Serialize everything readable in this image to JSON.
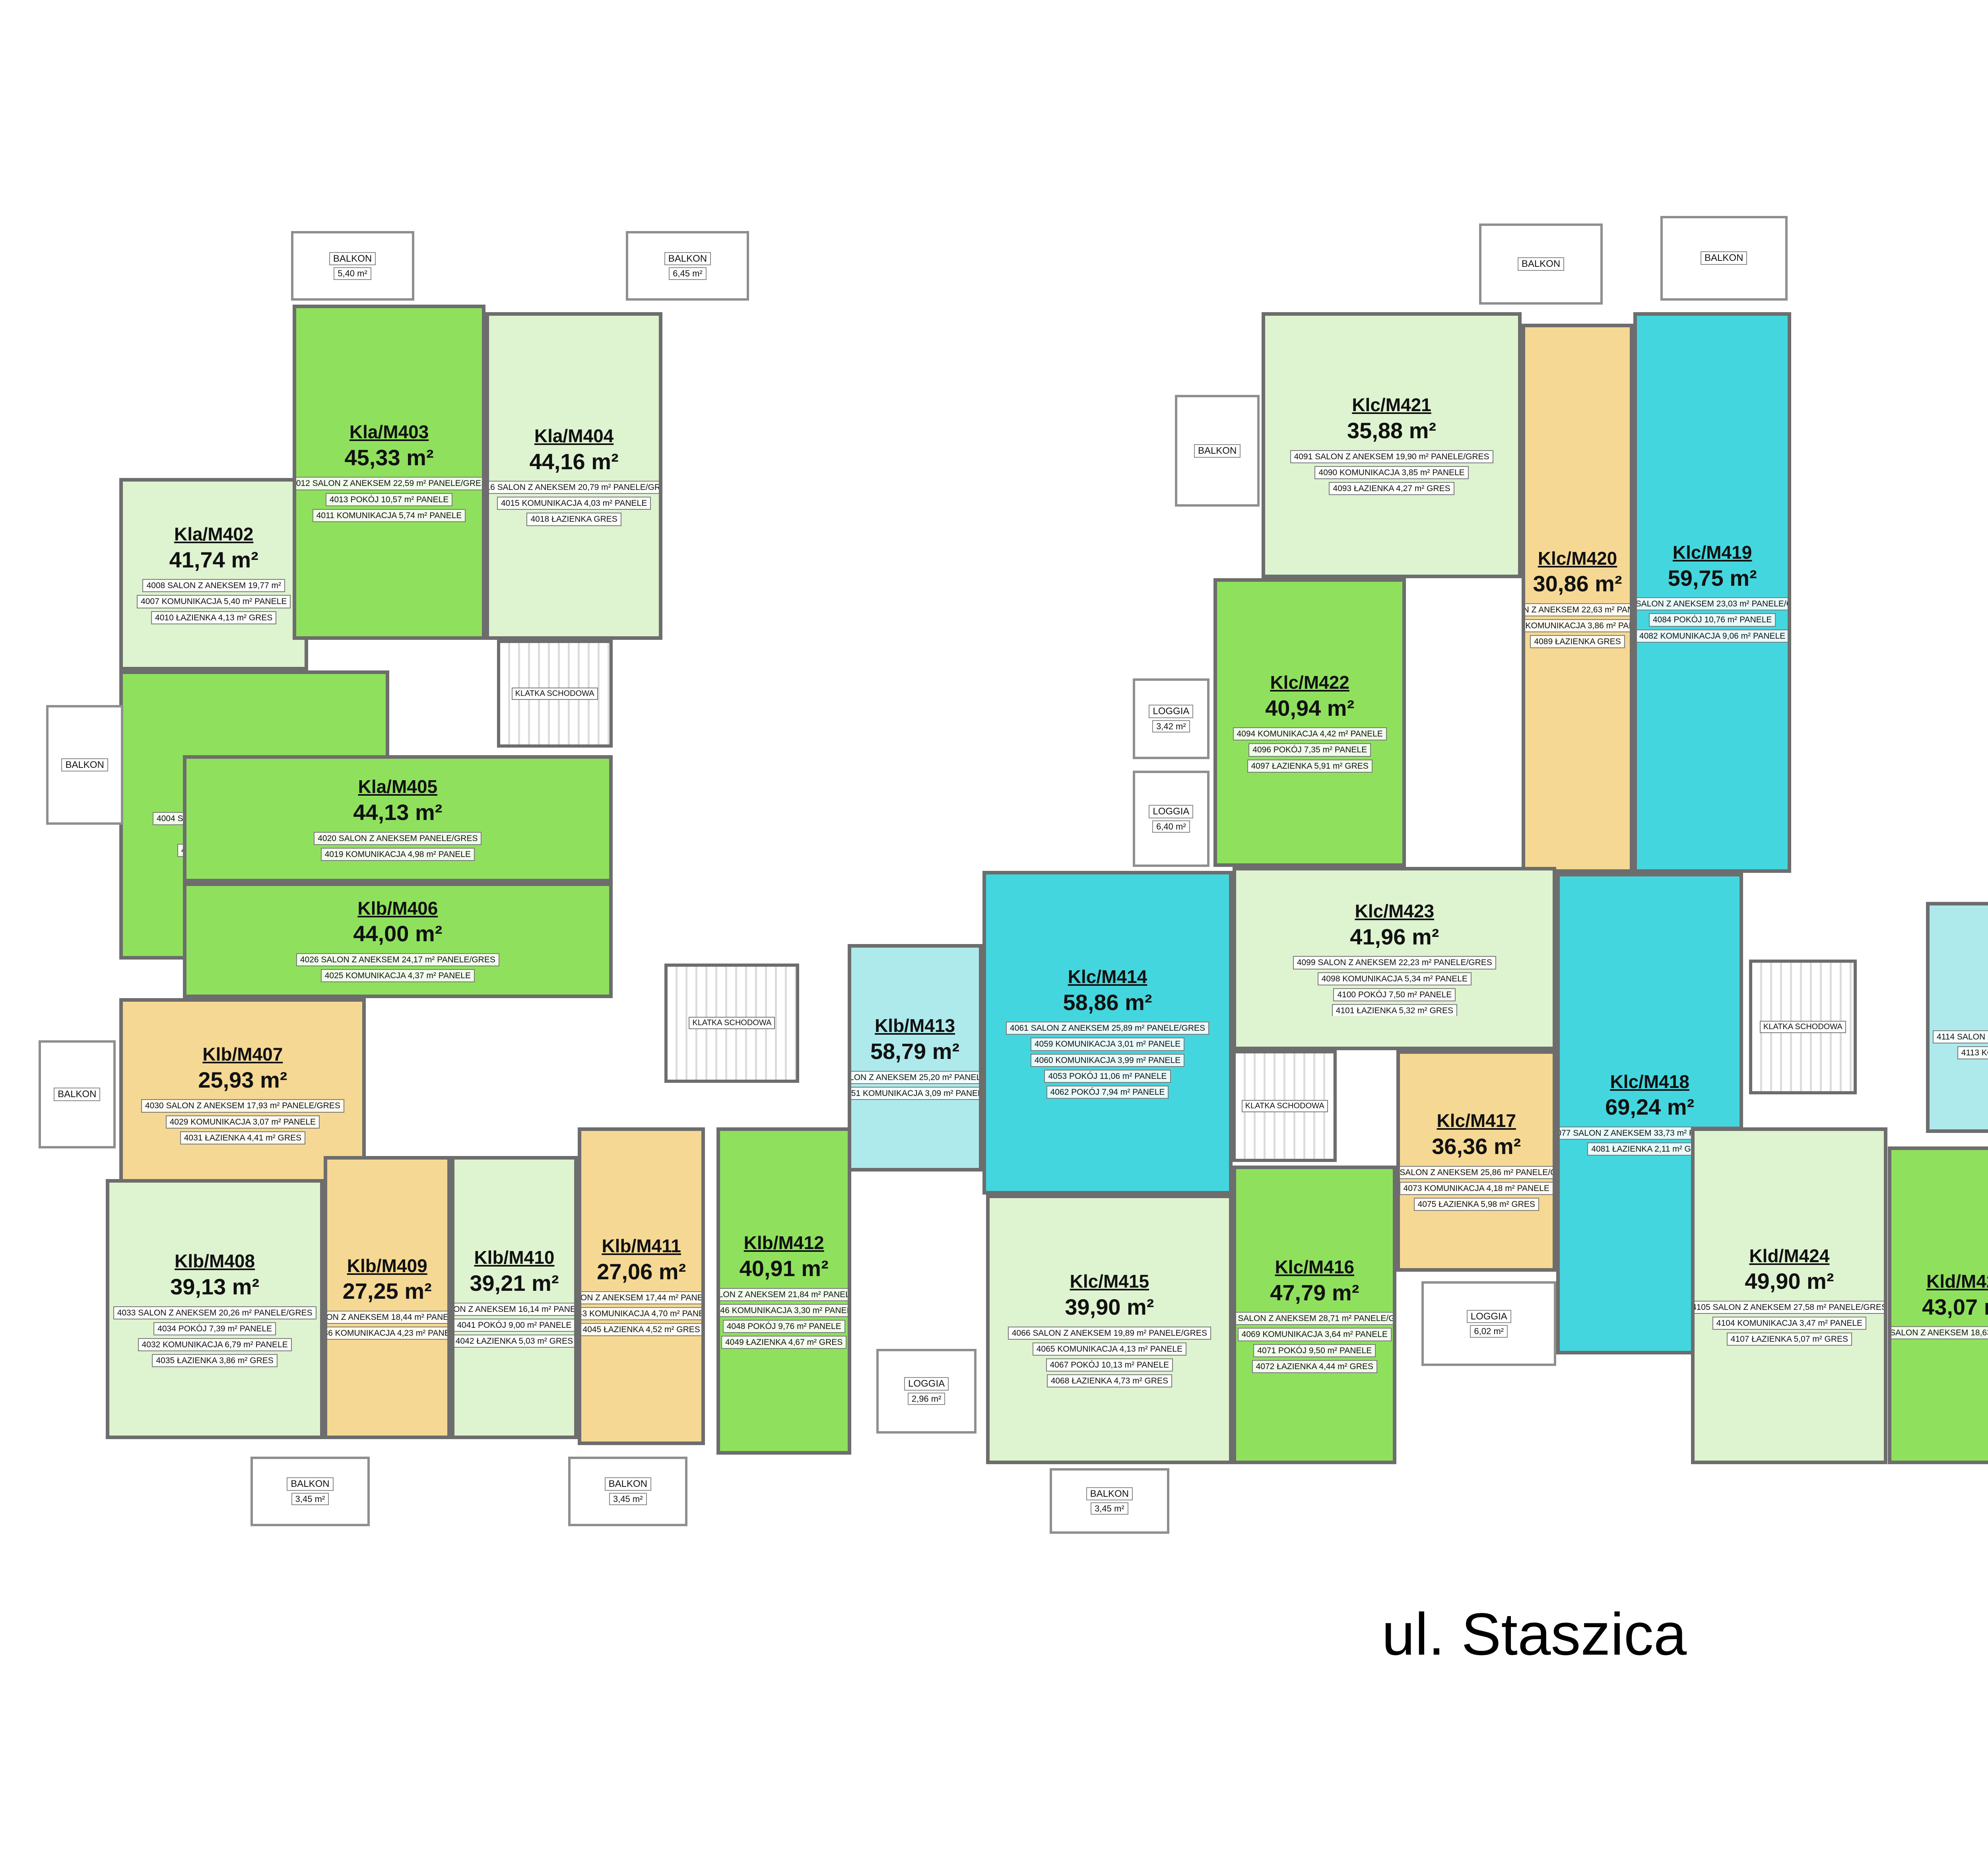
{
  "title": {
    "street_label": "ul. Staszica"
  },
  "compass": {
    "n": "N",
    "e": "E",
    "s": "S",
    "w": "W"
  },
  "stairwell_label": "KLATKA SCHODOWA",
  "palette": {
    "bright_green": "#8fe15d",
    "pale_green": "#def3d0",
    "orange": "#f5d893",
    "bright_cyan": "#44d6de",
    "pale_cyan": "#aeeaec",
    "wall": "#6d6d6d"
  },
  "apartments": [
    {
      "id": "Kla/M401",
      "area": "43,01 m²",
      "color": "bright_green",
      "rect": [
        62,
        348,
        140,
        150
      ],
      "rooms": [
        "4004 SALON Z ANEKSEM 18,53 m² PANELE/GRES",
        "4005 POKÓJ 11,66 m² PANELE",
        "4003 KOMUNIKACJA 4,78 m² PANELE",
        "4006 ŁAZIENKA 6,77 m² GRES"
      ]
    },
    {
      "id": "Kla/M402",
      "area": "41,74 m²",
      "color": "pale_green",
      "rect": [
        62,
        248,
        98,
        100
      ],
      "rooms": [
        "4008 SALON Z ANEKSEM 19,77 m²",
        "4007 KOMUNIKACJA 5,40 m² PANELE",
        "4010 ŁAZIENKA 4,13 m² GRES"
      ]
    },
    {
      "id": "Kla/M403",
      "area": "45,33 m²",
      "color": "bright_green",
      "rect": [
        152,
        158,
        100,
        174
      ],
      "rooms": [
        "4012 SALON Z ANEKSEM 22,59 m² PANELE/GRES",
        "4013 POKÓJ 10,57 m² PANELE",
        "4011 KOMUNIKACJA 5,74 m² PANELE"
      ]
    },
    {
      "id": "Kla/M404",
      "area": "44,16 m²",
      "color": "pale_green",
      "rect": [
        252,
        162,
        92,
        170
      ],
      "rooms": [
        "4016 SALON Z ANEKSEM 20,79 m² PANELE/GRES",
        "4015 KOMUNIKACJA 4,03 m² PANELE",
        "4018 ŁAZIENKA GRES"
      ]
    },
    {
      "id": "Kla/M405",
      "area": "44,13 m²",
      "color": "bright_green",
      "rect": [
        95,
        392,
        223,
        66
      ],
      "rooms": [
        "4020 SALON Z ANEKSEM PANELE/GRES",
        "4019 KOMUNIKACJA 4,98 m² PANELE"
      ]
    },
    {
      "id": "Klb/M406",
      "area": "44,00 m²",
      "color": "bright_green",
      "rect": [
        95,
        458,
        223,
        60
      ],
      "rooms": [
        "4026 SALON Z ANEKSEM 24,17 m² PANELE/GRES",
        "4025 KOMUNIKACJA 4,37 m² PANELE"
      ]
    },
    {
      "id": "Klb/M407",
      "area": "25,93 m²",
      "color": "orange",
      "rect": [
        62,
        518,
        128,
        100
      ],
      "rooms": [
        "4030 SALON Z ANEKSEM 17,93 m² PANELE/GRES",
        "4029 KOMUNIKACJA 3,07 m² PANELE",
        "4031 ŁAZIENKA 4,41 m² GRES"
      ]
    },
    {
      "id": "Klb/M408",
      "area": "39,13 m²",
      "color": "pale_green",
      "rect": [
        55,
        612,
        113,
        135
      ],
      "rooms": [
        "4033 SALON Z ANEKSEM 20,26 m² PANELE/GRES",
        "4034 POKÓJ 7,39 m² PANELE",
        "4032 KOMUNIKACJA 6,79 m² PANELE",
        "4035 ŁAZIENKA 3,86 m² GRES"
      ]
    },
    {
      "id": "Klb/M409",
      "area": "27,25 m²",
      "color": "orange",
      "rect": [
        168,
        600,
        66,
        147
      ],
      "rooms": [
        "4037 SALON Z ANEKSEM 18,44 m² PANELE/GRES",
        "4036 KOMUNIKACJA 4,23 m² PANELE"
      ]
    },
    {
      "id": "Klb/M410",
      "area": "39,21 m²",
      "color": "pale_green",
      "rect": [
        234,
        600,
        66,
        147
      ],
      "rooms": [
        "4040 SALON Z ANEKSEM 16,14 m² PANELE/GRES",
        "4041 POKÓJ 9,00 m² PANELE",
        "4042 ŁAZIENKA 5,03 m² GRES"
      ]
    },
    {
      "id": "Klb/M411",
      "area": "27,06 m²",
      "color": "orange",
      "rect": [
        300,
        585,
        66,
        165
      ],
      "rooms": [
        "4044 SALON Z ANEKSEM 17,44 m² PANELE/GRES",
        "4043 KOMUNIKACJA 4,70 m² PANELE",
        "4045 ŁAZIENKA 4,52 m² GRES"
      ]
    },
    {
      "id": "Klb/M412",
      "area": "40,91 m²",
      "color": "bright_green",
      "rect": [
        372,
        585,
        70,
        170
      ],
      "rooms": [
        "4047 SALON Z ANEKSEM 21,84 m² PANELE/GRES",
        "4046 KOMUNIKACJA 3,30 m² PANELE",
        "4048 POKÓJ 9,76 m² PANELE",
        "4049 ŁAZIENKA 4,67 m² GRES"
      ]
    },
    {
      "id": "Klb/M413",
      "area": "58,79 m²",
      "color": "pale_cyan",
      "rect": [
        440,
        490,
        70,
        118
      ],
      "rooms": [
        "4052 SALON Z ANEKSEM 25,20 m² PANELE/GRES",
        "4051 KOMUNIKACJA 3,09 m² PANELE"
      ]
    },
    {
      "id": "Klc/M414",
      "area": "58,86 m²",
      "color": "bright_cyan",
      "rect": [
        510,
        452,
        130,
        168
      ],
      "rooms": [
        "4061 SALON Z ANEKSEM 25,89 m² PANELE/GRES",
        "4059 KOMUNIKACJA 3,01 m² PANELE",
        "4060 KOMUNIKACJA 3,99 m² PANELE",
        "4053 POKÓJ 11,06 m² PANELE",
        "4062 POKÓJ 7,94 m² PANELE"
      ]
    },
    {
      "id": "Klc/M415",
      "area": "39,90 m²",
      "color": "pale_green",
      "rect": [
        512,
        620,
        128,
        140
      ],
      "rooms": [
        "4066 SALON Z ANEKSEM 19,89 m² PANELE/GRES",
        "4065 KOMUNIKACJA 4,13 m² PANELE",
        "4067 POKÓJ 10,13 m² PANELE",
        "4068 ŁAZIENKA 4,73 m² GRES"
      ]
    },
    {
      "id": "Klc/M416",
      "area": "47,79 m²",
      "color": "bright_green",
      "rect": [
        640,
        605,
        85,
        155
      ],
      "rooms": [
        "4070 SALON Z ANEKSEM 28,71 m² PANELE/GRES",
        "4069 KOMUNIKACJA 3,64 m² PANELE",
        "4071 POKÓJ 9,50 m² PANELE",
        "4072 ŁAZIENKA 4,44 m² GRES"
      ]
    },
    {
      "id": "Klc/M417",
      "area": "36,36 m²",
      "color": "orange",
      "rect": [
        725,
        545,
        83,
        115
      ],
      "rooms": [
        "4074 SALON Z ANEKSEM 25,86 m² PANELE/GRES",
        "4073 KOMUNIKACJA 4,18 m² PANELE",
        "4075 ŁAZIENKA 5,98 m² GRES"
      ]
    },
    {
      "id": "Klc/M418",
      "area": "69,24 m²",
      "color": "bright_cyan",
      "rect": [
        808,
        453,
        97,
        250
      ],
      "rooms": [
        "4077 SALON Z ANEKSEM 33,73 m² PANELE/GRES",
        "4081 ŁAZIENKA 2,11 m² GRES"
      ]
    },
    {
      "id": "Klc/M419",
      "area": "59,75 m²",
      "color": "bright_cyan",
      "rect": [
        848,
        162,
        82,
        291
      ],
      "rooms": [
        "4083 SALON Z ANEKSEM 23,03 m² PANELE/GRES",
        "4084 POKÓJ 10,76 m² PANELE",
        "4082 KOMUNIKACJA 9,06 m² PANELE"
      ]
    },
    {
      "id": "Klc/M420",
      "area": "30,86 m²",
      "color": "orange",
      "rect": [
        790,
        168,
        58,
        285
      ],
      "rooms": [
        "4088 SALON Z ANEKSEM 22,63 m² PANELE/GRES",
        "4087 KOMUNIKACJA 3,86 m² PANELE",
        "4089 ŁAZIENKA GRES"
      ]
    },
    {
      "id": "Klc/M421",
      "area": "35,88 m²",
      "color": "pale_green",
      "rect": [
        655,
        162,
        135,
        138
      ],
      "rooms": [
        "4091 SALON Z ANEKSEM 19,90 m² PANELE/GRES",
        "4090 KOMUNIKACJA 3,85 m² PANELE",
        "4093 ŁAZIENKA 4,27 m² GRES"
      ]
    },
    {
      "id": "Klc/M422",
      "area": "40,94 m²",
      "color": "bright_green",
      "rect": [
        630,
        300,
        100,
        150
      ],
      "rooms": [
        "4094 KOMUNIKACJA 4,42 m² PANELE",
        "4096 POKÓJ 7,35 m² PANELE",
        "4097 ŁAZIENKA 5,91 m² GRES"
      ]
    },
    {
      "id": "Klc/M423",
      "area": "41,96 m²",
      "color": "pale_green",
      "rect": [
        640,
        450,
        168,
        95
      ],
      "rooms": [
        "4099 SALON Z ANEKSEM 22,23 m² PANELE/GRES",
        "4098 KOMUNIKACJA 5,34 m² PANELE",
        "4100 POKÓJ 7,50 m² PANELE",
        "4101 ŁAZIENKA 5,32 m² GRES"
      ]
    },
    {
      "id": "Kld/M424",
      "area": "49,90 m²",
      "color": "pale_green",
      "rect": [
        878,
        585,
        102,
        175
      ],
      "rooms": [
        "4105 SALON Z ANEKSEM 27,58 m² PANELE/GRES",
        "4104 KOMUNIKACJA 3,47 m² PANELE",
        "4107 ŁAZIENKA 5,07 m² GRES"
      ]
    },
    {
      "id": "Kld/M425",
      "area": "43,07 m²",
      "color": "bright_green",
      "rect": [
        980,
        595,
        82,
        165
      ],
      "rooms": [
        "4109 SALON Z ANEKSEM 18,63 m² PANELE/GRES"
      ]
    },
    {
      "id": "Kld/M426",
      "area": "55,63 m²",
      "color": "pale_cyan",
      "rect": [
        1000,
        468,
        112,
        120
      ],
      "rooms": [
        "4114 SALON Z ANEKSEM 21,91 m² PANELE/GRES",
        "4113 KOMUNIKACJA 2,90 m² PANELE"
      ]
    },
    {
      "id": "Kle/M427",
      "area": "56,26 m²",
      "color": "bright_cyan",
      "rect": [
        1112,
        498,
        152,
        122
      ],
      "rooms": [
        "4121 SALON Z ANEKSEM 18,89 m² PANELE/GRES",
        "4120 KOMUNIKACJA 7,35 m² PANELE",
        "4123 POKÓJ 12,35 m² PANELE",
        "4124 ŁAZIENKA 4,60 m² GRES"
      ]
    },
    {
      "id": "Kle/M428",
      "area": "44,45 m²",
      "color": "pale_green",
      "rect": [
        1112,
        620,
        122,
        145
      ],
      "rooms": [
        "4125 KOMUNIKACJA 5,63 m² PANELE",
        "4128 ŁAZIENKA GRES"
      ]
    },
    {
      "id": "Kle/M429",
      "area": "44,09 m²",
      "color": "bright_green",
      "rect": [
        1234,
        620,
        100,
        145
      ],
      "rooms": [
        "4130 SALON Z ANEKSEM 21,56 m² PANELE/GRES",
        "4129 KOMUNIKACJA 4,49 m² PANELE",
        "4131 POKÓJ 11,09 m² PANELE",
        "4132 ŁAZIENKA 5,21 m² GRES"
      ]
    },
    {
      "id": "Kle/M430",
      "area": "42,50 m²",
      "color": "pale_green",
      "rect": [
        1334,
        592,
        104,
        173
      ],
      "rooms": [
        "4134 SALON Z ANEKSEM 21,73 m² PANELE/GRES",
        "4133 KOMUNIKACJA 3,81 m² PANELE",
        "4135 POKÓJ 10,95 m² PANELE",
        "4136 ŁAZIENKA 4,52 m² GRES"
      ]
    },
    {
      "id": "Kle/M431",
      "area": "61,11 m²",
      "color": "bright_cyan",
      "rect": [
        1438,
        570,
        92,
        200
      ],
      "rooms": [
        "4138 SALON Z ANEKSEM 24,06 m² PANELE/GRES"
      ]
    },
    {
      "id": "Kle/M432",
      "area": "47,45 m²",
      "color": "pale_green",
      "rect": [
        1285,
        448,
        245,
        112
      ],
      "rooms": [
        "4143 SALON Z ANEKSEM 22,72 m² PANELE/GRES",
        "4142 KOMUNIKACJA 2,84 m² PANELE"
      ]
    },
    {
      "id": "Klf/M433",
      "area": "47,61 m²",
      "color": "bright_green",
      "rect": [
        1285,
        375,
        245,
        73
      ],
      "rooms": [
        "4149 SALON Z ANEKSEM 22,79 m² PANELE/GRES"
      ]
    },
    {
      "id": "Klf/M434",
      "area": "44,64 m²",
      "color": "pale_green",
      "rect": [
        1285,
        290,
        245,
        85
      ],
      "rooms": [
        "4153 SALON Z ANEKSEM 19,60 m² PANELE/GRES",
        "4152 KOMUNIKACJA 6,45 m² PANELE",
        "4155 ŁAZIENKA 4,77 m² GRES"
      ]
    },
    {
      "id": "Klf/M435",
      "area": "55,28 m²",
      "color": "bright_cyan",
      "rect": [
        1382,
        150,
        148,
        140
      ],
      "rooms": [
        "4157 SALON Z ANEKSEM 17,51 m²",
        "4156 KOMUNIKACJA 10,73 m² PANELE",
        "4158 POKÓJ 10,50 m² PANELE"
      ]
    },
    {
      "id": "Klf/M436",
      "area": "35,92 m²",
      "color": "pale_green",
      "rect": [
        1294,
        160,
        88,
        130
      ],
      "rooms": [
        "4162 SALON Z ANEKSEM 19,54 m² PANELE",
        "4161 KOMUNIKACJA 2,65 m² PANELE",
        "4164 ŁAZIENKA 4,40 m² GRES",
        "4163 POKÓJ 8,29 m² PANELE"
      ]
    },
    {
      "id": "Klf/M437",
      "area": "52,50 m²",
      "color": "pale_cyan",
      "rect": [
        1185,
        195,
        109,
        235
      ],
      "rooms": [
        "4166 SALON Z ANEKSEM 23,30 m² PANELE/GRES",
        "4165 KOMUNIKACJA 6,12 m² PANELE",
        "4167 POKÓJ 8,46 m² PANELE",
        "4169 ŁAZIENKA 4,16 m² GRES"
      ]
    }
  ],
  "balconies": [
    {
      "name": "BALKON",
      "area": "5,40 m²",
      "rect": [
        151,
        120,
        64,
        36
      ]
    },
    {
      "name": "BALKON",
      "area": "6,45 m²",
      "rect": [
        325,
        120,
        64,
        36
      ]
    },
    {
      "name": "BALKON",
      "area": "",
      "rect": [
        24,
        366,
        40,
        62
      ]
    },
    {
      "name": "BALKON",
      "area": "",
      "rect": [
        20,
        540,
        40,
        56
      ]
    },
    {
      "name": "BALKON",
      "area": "3,45 m²",
      "rect": [
        130,
        756,
        62,
        36
      ]
    },
    {
      "name": "BALKON",
      "area": "3,45 m²",
      "rect": [
        295,
        756,
        62,
        36
      ]
    },
    {
      "name": "BALKON",
      "area": "3,45 m²",
      "rect": [
        545,
        762,
        62,
        34
      ]
    },
    {
      "name": "LOGGIA",
      "area": "2,96 m²",
      "rect": [
        455,
        700,
        52,
        44
      ]
    },
    {
      "name": "BALKON",
      "area": "",
      "rect": [
        610,
        205,
        44,
        58
      ]
    },
    {
      "name": "LOGGIA",
      "area": "3,42 m²",
      "rect": [
        588,
        352,
        40,
        42
      ]
    },
    {
      "name": "LOGGIA",
      "area": "6,40 m²",
      "rect": [
        588,
        400,
        40,
        50
      ]
    },
    {
      "name": "BALKON",
      "area": "",
      "rect": [
        768,
        116,
        64,
        42
      ]
    },
    {
      "name": "BALKON",
      "area": "",
      "rect": [
        862,
        112,
        66,
        44
      ]
    },
    {
      "name": "LOGGIA",
      "area": "6,02 m²",
      "rect": [
        738,
        665,
        70,
        44
      ]
    },
    {
      "name": "BALKON",
      "area": "6,62 m²",
      "rect": [
        1182,
        148,
        46,
        44
      ]
    },
    {
      "name": "BALKON",
      "area": "7,63 m²",
      "rect": [
        1114,
        454,
        70,
        42
      ]
    },
    {
      "name": "BALKON",
      "area": "",
      "rect": [
        1320,
        116,
        62,
        42
      ]
    },
    {
      "name": "BALKON",
      "area": "",
      "rect": [
        1452,
        116,
        62,
        42
      ]
    },
    {
      "name": "BALKON",
      "area": "",
      "rect": [
        1532,
        168,
        34,
        58
      ]
    },
    {
      "name": "BALKON",
      "area": "4,15 m²",
      "rect": [
        1534,
        360,
        32,
        32
      ]
    },
    {
      "name": "BALKON",
      "area": "3,64 m²",
      "rect": [
        1534,
        396,
        32,
        32
      ]
    },
    {
      "name": "BALKON",
      "area": "3,45 m²",
      "rect": [
        1534,
        488,
        32,
        32
      ]
    },
    {
      "name": "BALKON",
      "area": "3,45 m²",
      "rect": [
        1255,
        770,
        56,
        34
      ]
    },
    {
      "name": "BALKON",
      "area": "3,45 m²",
      "rect": [
        1330,
        770,
        48,
        34
      ]
    },
    {
      "name": "BALKON",
      "area": "9,38 m²",
      "rect": [
        1392,
        772,
        78,
        38
      ]
    },
    {
      "name": "BALKON",
      "area": "",
      "rect": [
        1150,
        768,
        55,
        34
      ]
    }
  ],
  "stairwells": [
    {
      "rect": [
        258,
        332,
        60,
        56
      ]
    },
    {
      "rect": [
        345,
        500,
        70,
        62
      ]
    },
    {
      "rect": [
        640,
        545,
        54,
        58
      ]
    },
    {
      "rect": [
        908,
        498,
        56,
        70
      ]
    },
    {
      "rect": [
        1266,
        560,
        54,
        52
      ]
    },
    {
      "rect": [
        1213,
        432,
        60,
        56
      ]
    }
  ]
}
